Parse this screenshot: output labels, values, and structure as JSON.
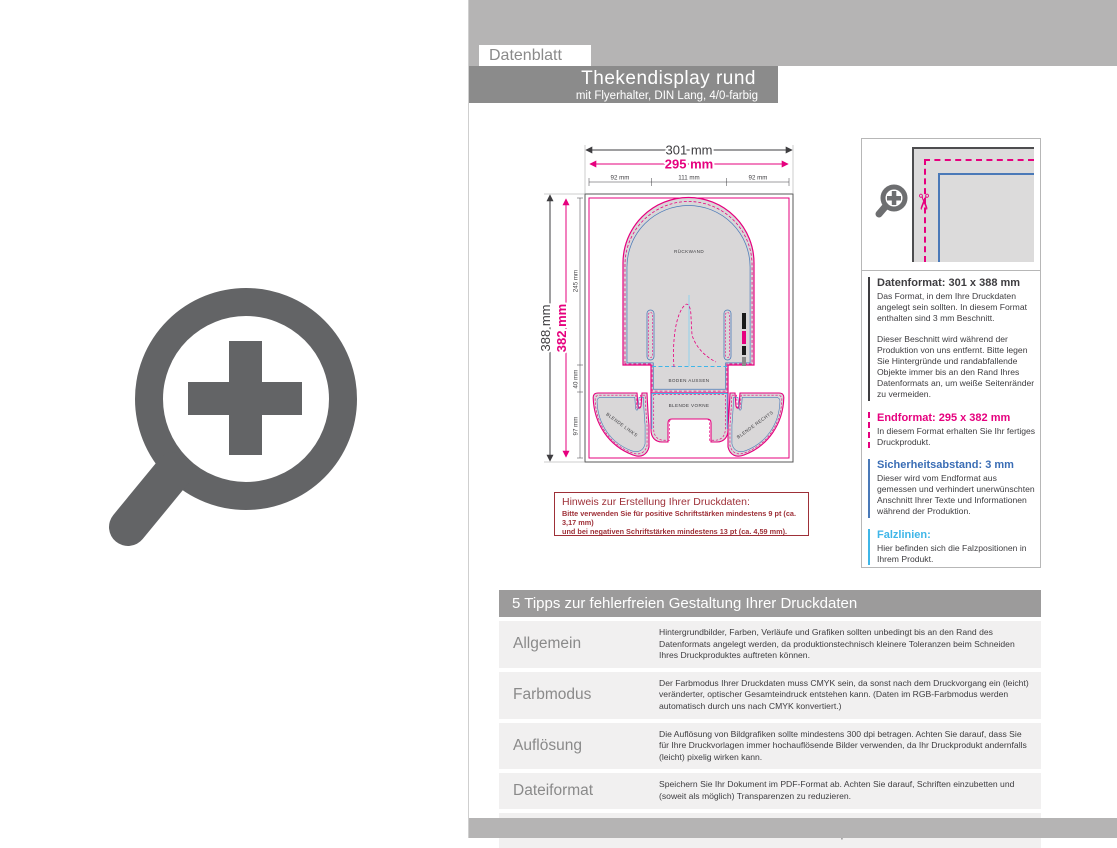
{
  "header": {
    "tab": "Datenblatt",
    "title": "Thekendisplay rund",
    "subtitle": "mit Flyerhalter, DIN Lang, 4/0-farbig"
  },
  "drawing": {
    "dims": {
      "w_outer": "301 mm",
      "w_inner": "295 mm",
      "w_seg1": "92 mm",
      "w_seg2": "111 mm",
      "w_seg3": "92 mm",
      "h_outer": "388 mm",
      "h_inner": "382 mm",
      "h_seg1": "245 mm",
      "h_seg2": "40 mm",
      "h_seg3": "97 mm"
    },
    "labels": {
      "back": "RÜCKWAND",
      "bottom": "BODEN AUSSEN",
      "front": "BLENDE VORNE",
      "wing_left": "BLENDE LINKS",
      "wing_right": "BLENDE RECHTS"
    }
  },
  "hint": {
    "title": "Hinweis zur Erstellung Ihrer Druckdaten:",
    "line1": "Bitte verwenden Sie für positive Schriftstärken mindestens 9 pt (ca. 3,17 mm)",
    "line2": "und bei negativen Schriftstärken mindestens 13 pt (ca. 4,59 mm)."
  },
  "panel": {
    "sections": [
      {
        "title": "Datenformat: 301 x 388 mm",
        "body": "Das Format, in dem Ihre Druckdaten angelegt sein sollten. In diesem Format enthalten sind 3 mm Beschnitt.",
        "body2": "Dieser Beschnitt wird während der Produktion von uns entfernt. Bitte legen Sie Hintergründe und randabfallende Objekte immer bis an den Rand Ihres Datenformats an, um weiße Seitenränder zu vermeiden.",
        "accent": "#3e3d40"
      },
      {
        "title": "Endformat: 295 x 382 mm",
        "body": "In diesem Format erhalten Sie Ihr fertiges Druckprodukt.",
        "accent": "#e6007e"
      },
      {
        "title": "Sicherheitsabstand: 3 mm",
        "body": "Dieser wird vom Endformat aus gemessen und verhindert unerwünschten Anschnitt Ihrer Texte und Informationen während der Produktion.",
        "accent": "#3a6db5"
      },
      {
        "title": "Falzlinien:",
        "body": "Hier befinden sich die Falzpositionen in Ihrem Produkt.",
        "accent": "#3fb6e8"
      }
    ]
  },
  "tips": {
    "header": "5 Tipps zur fehlerfreien Gestaltung Ihrer Druckdaten",
    "rows": [
      {
        "label": "Allgemein",
        "text": "Hintergrundbilder, Farben, Verläufe und Grafiken sollten unbedingt bis an den Rand des Datenformats angelegt werden, da produktionstechnisch kleinere Toleranzen beim Schneiden Ihres Druckproduktes auftreten können."
      },
      {
        "label": "Farbmodus",
        "text": "Der Farbmodus Ihrer Druckdaten muss CMYK sein, da sonst nach dem Druckvorgang ein (leicht) veränderter, optischer Gesamteindruck entstehen kann. (Daten im RGB-Farbmodus werden automatisch durch uns nach CMYK konvertiert.)"
      },
      {
        "label": "Auflösung",
        "text": "Die Auflösung von Bildgrafiken sollte mindestens 300 dpi betragen. Achten Sie darauf, dass Sie für Ihre Druckvorlagen immer hochauflösende Bilder verwenden, da Ihr Druckprodukt andernfalls (leicht) pixelig wirken kann."
      },
      {
        "label": "Dateiformat",
        "text": "Speichern Sie Ihr Dokument im PDF-Format ab. Achten Sie darauf, Schriften einzubetten und (soweit als möglich) Transparenzen zu reduzieren."
      },
      {
        "label": "Seiten(-reihenfolge)",
        "text": "Senden Sie mehrseitige Dokumente chronologisch in korrekter Reihenfolge als eine einzige PDF-Datei oder benennen Sie Einzeldokumente entsprechend mit fortlaufenden Seitennummern."
      }
    ]
  },
  "colors": {
    "magenta_bleed": "#e6007e",
    "blue_safety": "#4a79b8",
    "cyan_fold": "#3fb6e8",
    "dark_red_hint": "#9e3038",
    "gray_band": "#b5b4b4",
    "gray_titlebar": "#8b8b8b",
    "gray_icon": "#636466"
  }
}
